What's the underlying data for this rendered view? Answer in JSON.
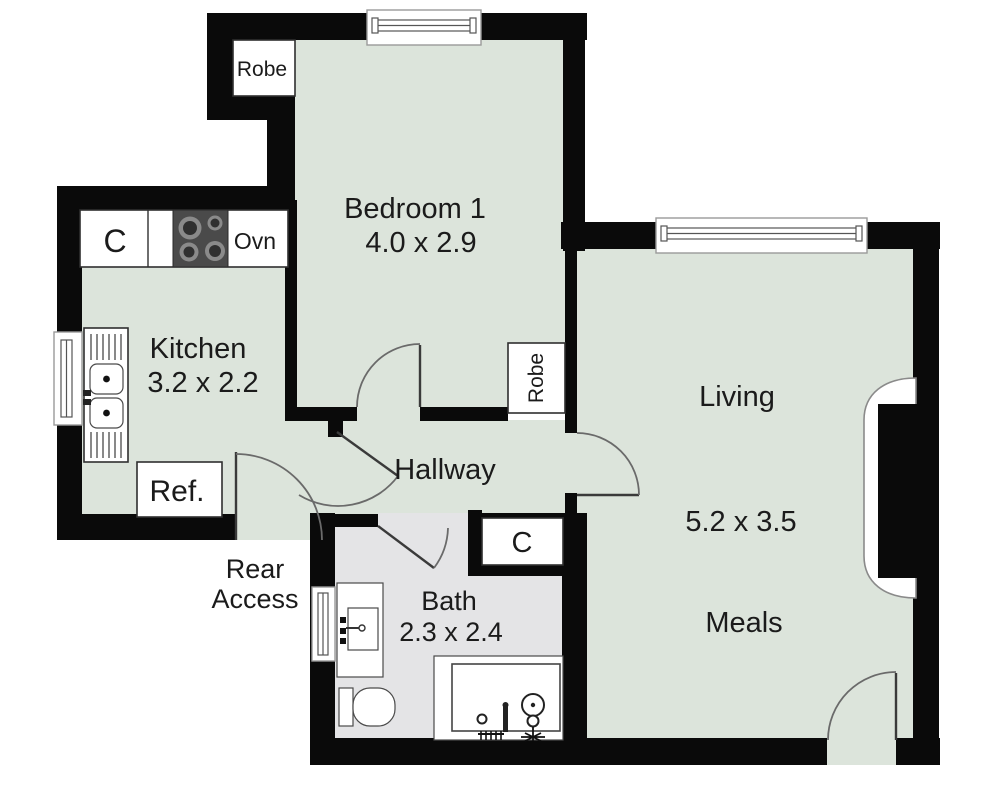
{
  "colors": {
    "floor_green": "#dce4db",
    "bath_floor_gray": "#e4e4e6",
    "wall_black": "#0a0a0a",
    "door_arc_gray": "#6a6a6a",
    "text_color": "#1b1b1b"
  },
  "rooms": [
    {
      "name": "Bedroom 1",
      "dimensions": "4.0 x 2.9"
    },
    {
      "name": "Kitchen",
      "dimensions": "3.2 x 2.2"
    },
    {
      "name": "Hallway"
    },
    {
      "name": "Living",
      "dimensions": "5.2 x 3.5",
      "secondary_label": "Meals"
    },
    {
      "name": "Bath",
      "dimensions": "2.3 x 2.4"
    }
  ],
  "fixtures": {
    "robe_bedroom_top": "Robe",
    "robe_bedroom_side": "Robe",
    "kitchen_cupboard": "C",
    "oven": "Ovn",
    "fridge": "Ref.",
    "hall_cupboard": "C"
  },
  "annotations": {
    "rear_access_line1": "Rear",
    "rear_access_line2": "Access"
  }
}
